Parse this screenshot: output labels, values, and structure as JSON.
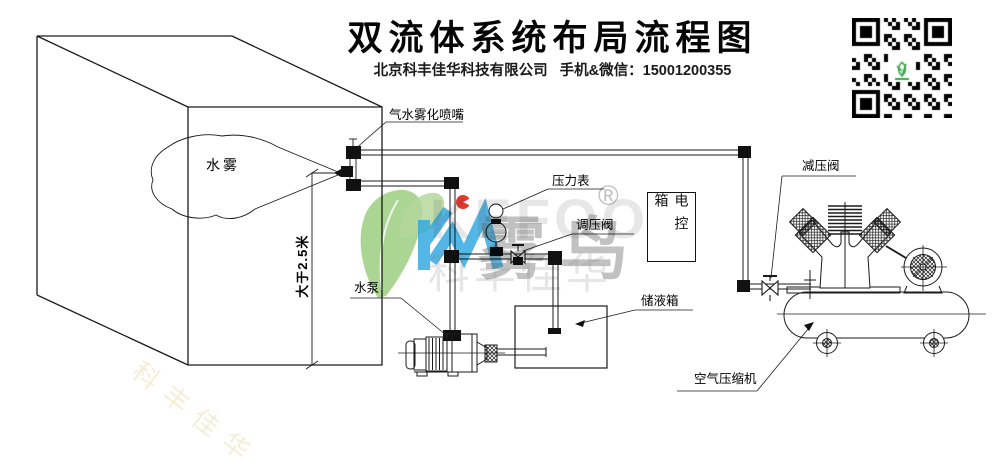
{
  "header": {
    "title": "双流体系统布局流程图",
    "company": "北京科丰佳华科技有限公司",
    "contact": "手机&微信：15001200355"
  },
  "labels": {
    "nozzle": "气水雾化喷嘴",
    "pressure_gauge": "压力表",
    "regulating_valve": "调压阀",
    "control_box": "电控箱",
    "reducing_valve": "减压阀",
    "water_pump": "水泵",
    "liquid_tank": "储液箱",
    "air_compressor": "空气压缩机",
    "water_mist": "水雾",
    "mount_height": "大于2.5米"
  },
  "watermark": {
    "brand_latin": "KEFOO",
    "brand_cn": "雾鸟",
    "company_cn": "科丰佳华",
    "registered": "®",
    "colors": {
      "leaf_green": "#94c973",
      "logo_blue": "#2ea7e0",
      "dot_red": "#e5372c",
      "qr_logo_green": "#3aa54a"
    }
  }
}
